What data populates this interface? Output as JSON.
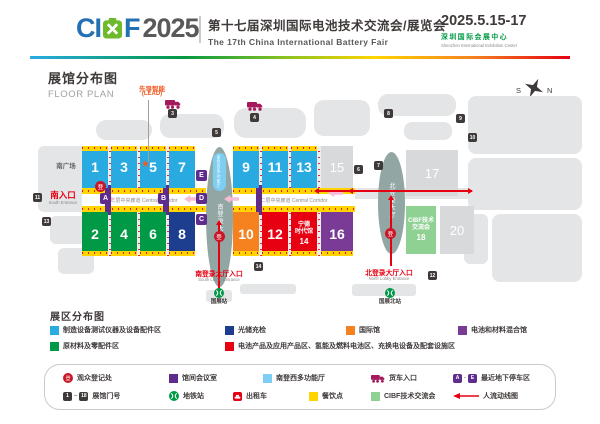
{
  "header": {
    "logo_ci": "CI",
    "logo_f": "F",
    "logo_year": "2025",
    "title_cn": "第十七届深圳国际电池技术交流会/展览会",
    "title_en": "The 17th China International Battery Fair",
    "date": "2025.5.15-17",
    "venue_cn": "深圳国际会展中心",
    "venue_en": "Shenzhen International Exhibition Center"
  },
  "plan": {
    "title_cn": "展馆分布图",
    "title_en": "FLOOR PLAN",
    "compass_s": "S",
    "compass_n": "N"
  },
  "map": {
    "reg_char": "登",
    "south_square_label": "南广场",
    "corridor_label": "二层中央廊道 Central Corridor",
    "lead_cn": "先导智能",
    "lead_en": "(LEAD)",
    "buildings": [
      {
        "x": 38,
        "y": 146,
        "w": 56,
        "h": 66,
        "r": 6
      },
      {
        "x": 50,
        "y": 216,
        "w": 44,
        "h": 28,
        "r": 6
      },
      {
        "x": 58,
        "y": 248,
        "w": 36,
        "h": 26,
        "r": 6
      },
      {
        "x": 96,
        "y": 120,
        "w": 56,
        "h": 20,
        "r": 10
      },
      {
        "x": 160,
        "y": 114,
        "w": 64,
        "h": 24,
        "r": 10
      },
      {
        "x": 234,
        "y": 108,
        "w": 72,
        "h": 30,
        "r": 12
      },
      {
        "x": 314,
        "y": 100,
        "w": 56,
        "h": 36,
        "r": 10
      },
      {
        "x": 378,
        "y": 94,
        "w": 78,
        "h": 22,
        "r": 10
      },
      {
        "x": 404,
        "y": 122,
        "w": 48,
        "h": 18,
        "r": 8
      },
      {
        "x": 468,
        "y": 96,
        "w": 114,
        "h": 58,
        "r": 8
      },
      {
        "x": 468,
        "y": 158,
        "w": 114,
        "h": 52,
        "r": 8
      },
      {
        "x": 492,
        "y": 214,
        "w": 90,
        "h": 68,
        "r": 8
      },
      {
        "x": 464,
        "y": 214,
        "w": 24,
        "h": 50,
        "r": 6
      },
      {
        "x": 352,
        "y": 188,
        "w": 120,
        "h": 11,
        "r": 2
      },
      {
        "x": 206,
        "y": 290,
        "w": 26,
        "h": 12,
        "r": 3
      },
      {
        "x": 352,
        "y": 284,
        "w": 64,
        "h": 12,
        "r": 3
      },
      {
        "x": 240,
        "y": 284,
        "w": 56,
        "h": 10,
        "r": 3
      }
    ],
    "corridors": [
      {
        "x": 82,
        "w": 124
      },
      {
        "x": 233,
        "w": 122
      }
    ],
    "vcorridors": [
      {
        "x": 108,
        "y": 146,
        "h": 42
      },
      {
        "x": 137,
        "y": 146,
        "h": 42
      },
      {
        "x": 166,
        "y": 146,
        "h": 42
      },
      {
        "x": 108,
        "y": 212,
        "h": 44
      },
      {
        "x": 137,
        "y": 212,
        "h": 44
      },
      {
        "x": 166,
        "y": 212,
        "h": 44
      },
      {
        "x": 259,
        "y": 146,
        "h": 42
      },
      {
        "x": 288,
        "y": 146,
        "h": 42
      },
      {
        "x": 317,
        "y": 146,
        "h": 42
      },
      {
        "x": 259,
        "y": 212,
        "h": 44
      },
      {
        "x": 288,
        "y": 212,
        "h": 44
      },
      {
        "x": 317,
        "y": 212,
        "h": 44
      }
    ],
    "meeting_bars": [
      {
        "x": 105,
        "y": 185,
        "h": 30
      },
      {
        "x": 163,
        "y": 185,
        "h": 30
      },
      {
        "x": 256,
        "y": 185,
        "h": 30
      }
    ],
    "halls": [
      {
        "no": "1",
        "x": 82,
        "y": 146,
        "w": 26,
        "h": 42,
        "color": "#29abe2",
        "stripe": "top"
      },
      {
        "no": "3",
        "x": 111,
        "y": 146,
        "w": 26,
        "h": 42,
        "color": "#29abe2",
        "stripe": "top"
      },
      {
        "no": "5",
        "x": 140,
        "y": 146,
        "w": 26,
        "h": 42,
        "color": "#29abe2",
        "stripe": "top",
        "star": true
      },
      {
        "no": "7",
        "x": 169,
        "y": 146,
        "w": 26,
        "h": 42,
        "color": "#29abe2",
        "stripe": "top"
      },
      {
        "no": "9",
        "x": 233,
        "y": 146,
        "w": 26,
        "h": 42,
        "color": "#29abe2",
        "stripe": "top"
      },
      {
        "no": "11",
        "x": 262,
        "y": 146,
        "w": 26,
        "h": 42,
        "color": "#29abe2",
        "stripe": "top"
      },
      {
        "no": "13",
        "x": 291,
        "y": 146,
        "w": 26,
        "h": 42,
        "color": "#29abe2",
        "stripe": "top"
      },
      {
        "no": "15",
        "x": 321,
        "y": 146,
        "w": 32,
        "h": 42,
        "color": "#d8d9da",
        "dim": true
      },
      {
        "no": "17",
        "x": 406,
        "y": 150,
        "w": 52,
        "h": 46,
        "color": "#d8d9da",
        "dim": true
      },
      {
        "no": "2",
        "x": 82,
        "y": 212,
        "w": 26,
        "h": 44,
        "color": "#009945",
        "stripe": "bottom"
      },
      {
        "no": "4",
        "x": 111,
        "y": 212,
        "w": 26,
        "h": 44,
        "color": "#009945",
        "stripe": "bottom"
      },
      {
        "no": "6",
        "x": 140,
        "y": 212,
        "w": 26,
        "h": 44,
        "color": "#009945",
        "stripe": "bottom"
      },
      {
        "no": "8",
        "x": 169,
        "y": 212,
        "w": 26,
        "h": 44,
        "color": "#1d3d8e",
        "stripe": "bottom"
      },
      {
        "no": "10",
        "x": 233,
        "y": 212,
        "w": 26,
        "h": 44,
        "color": "#f5821f",
        "stripe": "bottom"
      },
      {
        "no": "12",
        "x": 262,
        "y": 212,
        "w": 26,
        "h": 44,
        "color": "#e60012",
        "stripe": "bottom"
      },
      {
        "no": "14",
        "x": 291,
        "y": 212,
        "w": 26,
        "h": 44,
        "color": "#e60012",
        "stripe": "bottom",
        "lines": [
          "宁德",
          "时代馆",
          "14"
        ]
      },
      {
        "no": "16",
        "x": 321,
        "y": 212,
        "w": 32,
        "h": 44,
        "color": "#7a3b96",
        "stripe": "bottom"
      },
      {
        "no": "18",
        "x": 406,
        "y": 206,
        "w": 30,
        "h": 48,
        "color": "#8fd192",
        "lines": [
          "CIBF技术",
          "交流会",
          "18"
        ]
      },
      {
        "no": "20",
        "x": 440,
        "y": 206,
        "w": 34,
        "h": 48,
        "color": "#d8d9da",
        "dim": true
      }
    ],
    "gates": [
      {
        "no": "3",
        "x": 168,
        "y": 109
      },
      {
        "no": "4",
        "x": 250,
        "y": 113
      },
      {
        "no": "5",
        "x": 212,
        "y": 128
      },
      {
        "no": "8",
        "x": 384,
        "y": 109
      },
      {
        "no": "6",
        "x": 354,
        "y": 165
      },
      {
        "no": "7",
        "x": 374,
        "y": 161
      },
      {
        "no": "9",
        "x": 456,
        "y": 114
      },
      {
        "no": "10",
        "x": 468,
        "y": 133
      },
      {
        "no": "11",
        "x": 33,
        "y": 193
      },
      {
        "no": "13",
        "x": 42,
        "y": 217
      },
      {
        "no": "14",
        "x": 254,
        "y": 262
      },
      {
        "no": "12",
        "x": 428,
        "y": 271
      }
    ],
    "parking": [
      {
        "id": "A",
        "x": 100,
        "y": 193
      },
      {
        "id": "B",
        "x": 158,
        "y": 193
      },
      {
        "id": "E",
        "x": 196,
        "y": 170
      },
      {
        "id": "D",
        "x": 196,
        "y": 193
      },
      {
        "id": "C",
        "x": 196,
        "y": 214
      }
    ],
    "lobbies": {
      "south": {
        "label": "南登录大厅",
        "sub": "南登西多功能厅",
        "x": 206,
        "y": 147,
        "w": 27,
        "h": 140
      },
      "north": {
        "label": "北登录大厅",
        "x": 378,
        "y": 152,
        "w": 27,
        "h": 102
      }
    },
    "entrances": {
      "south_gate_cn": "南入口",
      "south_gate_en": "South Entrance",
      "south_lobby_cn": "南登录大厅入口",
      "south_lobby_en": "South Lobby Entrance",
      "north_lobby_cn": "北登录大厅入口",
      "north_lobby_en": "North Lobby Entrance"
    },
    "stations": {
      "south": "国展站",
      "north": "国展北站"
    }
  },
  "zone_legend": {
    "title": "展区分布图",
    "rows": [
      [
        {
          "color": "#29abe2",
          "label": "制造设备测试仪器及设备配件区",
          "x": 50
        },
        {
          "color": "#1d3d8e",
          "label": "光储充检",
          "x": 225
        },
        {
          "color": "#f5821f",
          "label": "国际馆",
          "x": 346
        },
        {
          "color": "#7a3b96",
          "label": "电池和材料混合馆",
          "x": 458
        }
      ],
      [
        {
          "color": "#009945",
          "label": "原材料及零配件区",
          "x": 50
        },
        {
          "color": "#e60012",
          "label": "电池产品及应用产品区、氢能及燃料电池区、充换电设备及配套设施区",
          "x": 225
        }
      ]
    ]
  },
  "symbol_legend": {
    "gate_from": "1",
    "gate_to": "18",
    "park_from": "A",
    "park_to": "E",
    "rows": [
      [
        {
          "icon": "reg",
          "label": "观众登记处",
          "x": 62
        },
        {
          "icon": "sq:#5f2c8e",
          "label": "馆间会议室",
          "x": 168
        },
        {
          "icon": "sq:#7ecef4",
          "label": "南登西多功能厅",
          "x": 262
        },
        {
          "icon": "truck",
          "label": "货车入口",
          "x": 370
        },
        {
          "icon": "ae",
          "label": "最近地下停车区",
          "x": 452
        }
      ],
      [
        {
          "icon": "gates",
          "label": "展馆门号",
          "x": 62
        },
        {
          "icon": "metro",
          "label": "地铁站",
          "x": 168
        },
        {
          "icon": "taxi",
          "label": "出租车",
          "x": 232
        },
        {
          "icon": "sq:#ffd400",
          "label": "餐饮点",
          "x": 308
        },
        {
          "icon": "sq:#8fd192",
          "label": "CIBF技术交流会",
          "x": 370
        },
        {
          "icon": "arrow",
          "label": "人流动线图",
          "x": 452
        }
      ]
    ]
  }
}
